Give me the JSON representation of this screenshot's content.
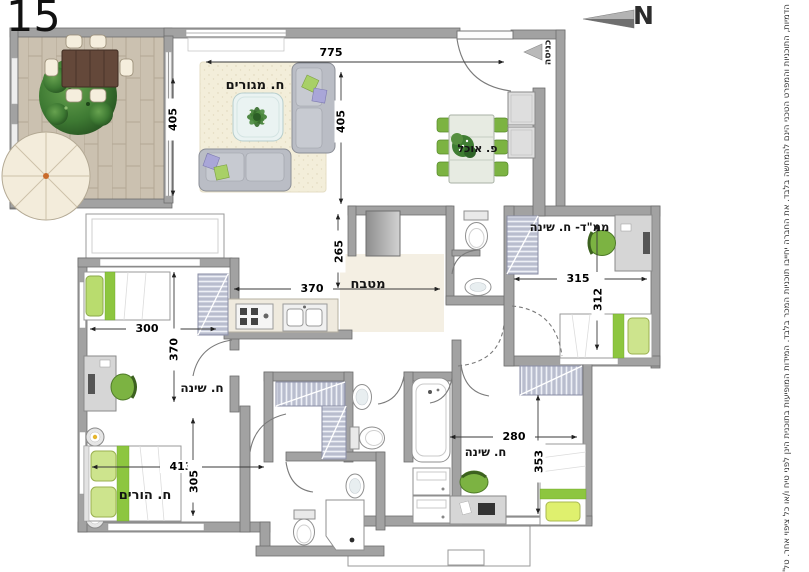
{
  "plan": {
    "unit_number": "15",
    "compass": {
      "label": "N"
    },
    "entrance": {
      "label": "כניסה"
    },
    "disclaimer": "הדמיות, התוכניות והמפרט הטכני הינם להמחשה בלבד. את החברה יחייבו תוכניות המכר בלבד. המידות המופיעות בתוכנית הינן לפני טיח ו/או כל ציפוי אחר. טל\"ח",
    "rooms": {
      "living": {
        "label": "ח. מגורים"
      },
      "dining": {
        "label": "פ. אוכל"
      },
      "kitchen": {
        "label": "מטבח"
      },
      "mamad": {
        "label": "ממ\"ד- ח. שינה"
      },
      "bedroom_left": {
        "label": "ח. שינה"
      },
      "parents": {
        "label": "ח. הורים"
      },
      "bedroom_bottom": {
        "label": "ח. שינה"
      }
    },
    "dims": {
      "living_width": "775",
      "living_height": "405",
      "balcony_height": "405",
      "kitchen_depth": "265",
      "kitchen_width": "370",
      "bedroom_left_width": "300",
      "bedroom_left_depth": "370",
      "mamad_width": "315",
      "mamad_depth": "312",
      "parents_width": "413",
      "parents_depth": "305",
      "bedroom_bottom_width": "280",
      "bedroom_bottom_depth": "353"
    },
    "colors": {
      "wall": "#a2a2a2",
      "accent_green": "#8dc63f",
      "wood": "#cbc1b0",
      "sofa": "#babdc5"
    }
  }
}
